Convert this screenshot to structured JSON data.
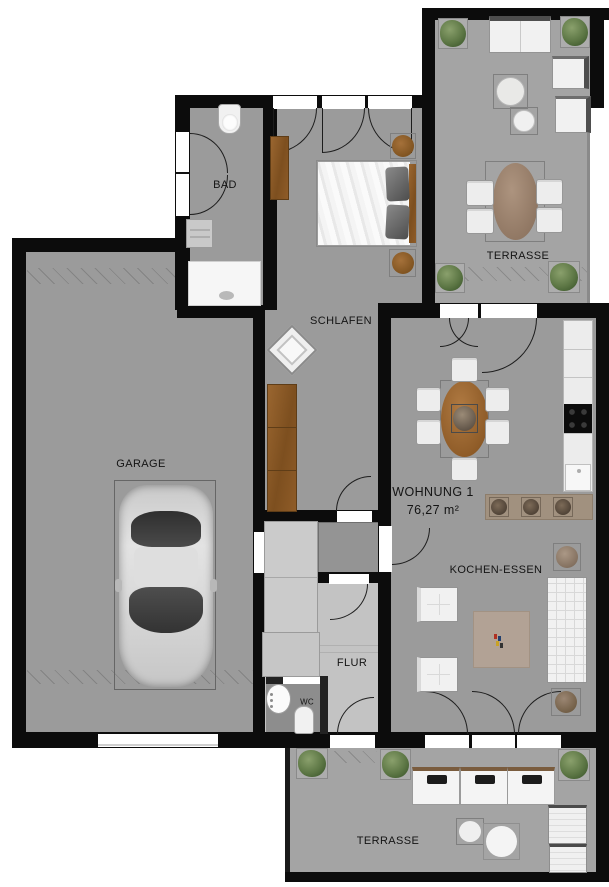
{
  "labels": {
    "garage": "GARAGE",
    "bad": "BAD",
    "schlafen": "SCHLAFEN",
    "flur": "FLUR",
    "wc": "WC",
    "kochen_essen": "KOCHEN-ESSEN",
    "terrasse_top": "TERRASSE",
    "terrasse_bottom": "TERRASSE",
    "wohnung_name": "WOHNUNG 1",
    "wohnung_area": "76,27 m²"
  },
  "colors": {
    "wall": "#0c0c0c",
    "floor_interior": "#9b9b9b",
    "floor_terrace": "#a4a4a4",
    "floor_hall": "#c3c3c3",
    "floor_wc": "#8d8d8d",
    "wood": "#8f5c28",
    "kitchen_counter": "#ececec",
    "cooktop": "#0c0c0c",
    "bar_counter": "#a1917f",
    "rug": "#b2a295",
    "plant_green": "#5d7745",
    "furniture_white": "#f1f1f1"
  }
}
